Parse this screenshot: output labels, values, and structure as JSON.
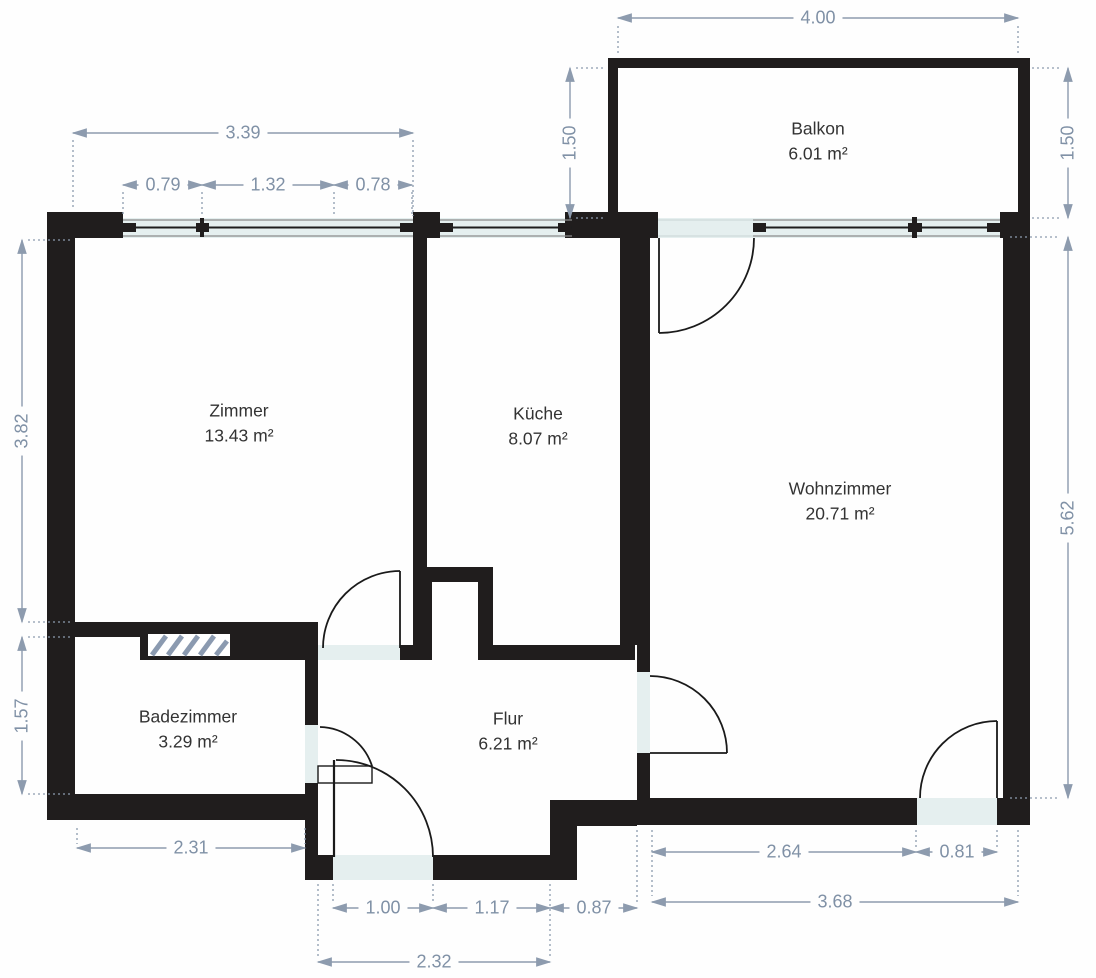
{
  "plan": {
    "rooms": [
      {
        "id": "balkon",
        "name": "Balkon",
        "area": "6.01 m²"
      },
      {
        "id": "zimmer",
        "name": "Zimmer",
        "area": "13.43 m²"
      },
      {
        "id": "kueche",
        "name": "Küche",
        "area": "8.07 m²"
      },
      {
        "id": "wohnzimmer",
        "name": "Wohnzimmer",
        "area": "20.71 m²"
      },
      {
        "id": "badezimmer",
        "name": "Badezimmer",
        "area": "3.29 m²"
      },
      {
        "id": "flur",
        "name": "Flur",
        "area": "6.21 m²"
      }
    ],
    "dimensions": {
      "balcony_width": "4.00",
      "balcony_depth_left": "1.50",
      "balcony_depth_right": "1.50",
      "zimmer_top_total": "3.39",
      "zimmer_win_left": "0.79",
      "zimmer_win_mid": "1.32",
      "zimmer_win_right": "0.78",
      "zimmer_left_height": "3.82",
      "bad_left_height": "1.57",
      "wohnzimmer_right_height": "5.62",
      "bad_bottom_width": "2.31",
      "wohnzimmer_bottom_seg": "2.64",
      "wohnzimmer_door_width": "0.81",
      "wohnzimmer_bottom_total": "3.68",
      "entry_door_width": "1.00",
      "flur_bottom_mid": "1.17",
      "flur_bottom_right": "0.87",
      "vestibule_width": "2.32"
    },
    "colors": {
      "wall": "#201d1d",
      "dimension": "#8d9bae",
      "window_tint": "#e5efef",
      "label": "#333333"
    }
  }
}
